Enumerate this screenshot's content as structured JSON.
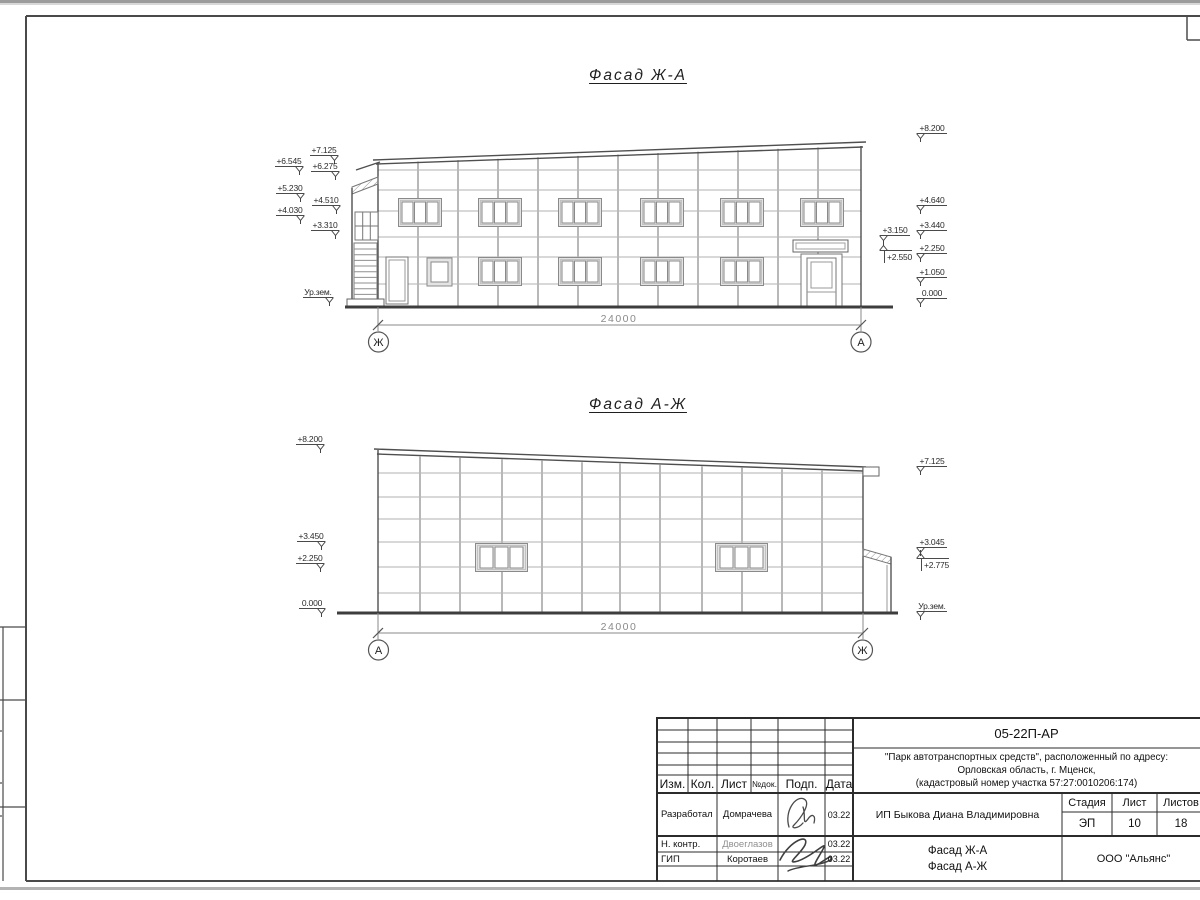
{
  "facades": {
    "f1": {
      "title": "Фасад Ж-А",
      "dim": "24000",
      "axisL": "Ж",
      "axisR": "А",
      "left_marks": [
        "+7.125",
        "+6.545",
        "+6.275",
        "+5.230",
        "+4.510",
        "+4.030",
        "+3.310",
        "Ур.зем."
      ],
      "near_marks": [
        "+3.150",
        "+2.550"
      ],
      "right_marks": [
        "+8.200",
        "+4.640",
        "+3.440",
        "+2.250",
        "+1.050",
        "0.000"
      ]
    },
    "f2": {
      "title": "Фасад А-Ж",
      "dim": "24000",
      "axisL": "А",
      "axisR": "Ж",
      "left_marks": [
        "+8.200",
        "+3.450",
        "+2.250",
        "0.000"
      ],
      "right_marks": [
        "+7.125",
        "+3.045",
        "+2.775",
        "Ур.зем."
      ]
    }
  },
  "titleblock": {
    "code": "05-22П-АР",
    "project_line1": "\"Парк автотранспортных средств\",  расположенный по адресу:",
    "project_line2": "Орловская область, г. Мценск,",
    "project_line3": "(кадастровый номер участка 57:27:0010206:174)",
    "client": "ИП Быкова Диана Владимировна",
    "sheet_title_line1": "Фасад Ж-А",
    "sheet_title_line2": "Фасад А-Ж",
    "company": "ООО \"Альянс\"",
    "headers": {
      "izm": "Изм.",
      "kol": "Кол.",
      "list": "Лист",
      "ndok": "№док.",
      "podp": "Подп.",
      "data": "Дата",
      "stage": "Стадия",
      "sheet": "Лист",
      "sheets": "Листов"
    },
    "stage": "ЭП",
    "sheet_no": "10",
    "sheet_total": "18",
    "rows": [
      {
        "role": "Разработал",
        "name": "Домрачева",
        "date": "03.22"
      },
      {
        "role": "Н. контр.",
        "name": "Двоеглазов",
        "date": "03.22"
      },
      {
        "role": "ГИП",
        "name": "Коротаев",
        "date": "03.22"
      }
    ]
  }
}
